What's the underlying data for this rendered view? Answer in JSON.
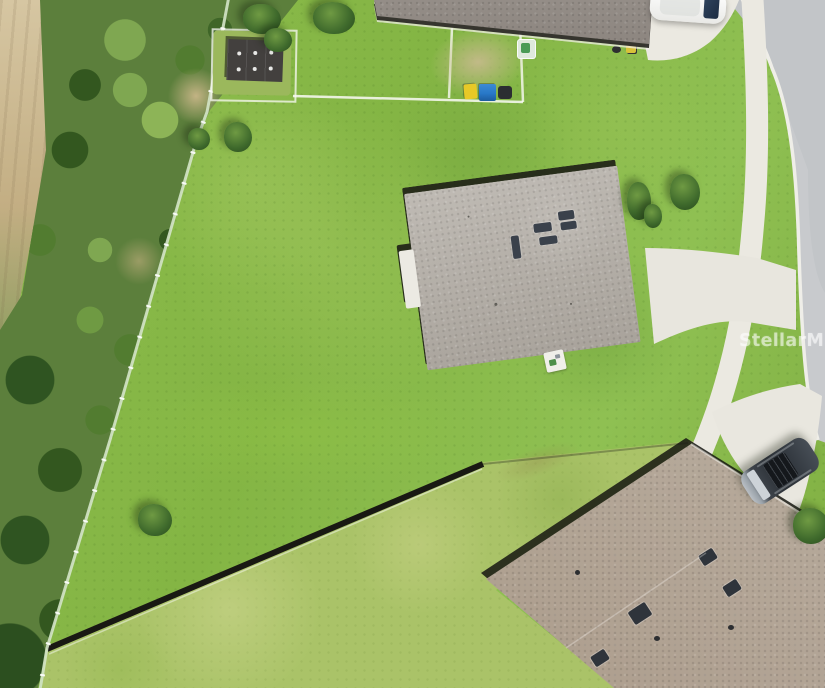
{
  "watermark": {
    "text": "StellarMLS",
    "color": "rgba(255,255,255,0.55)"
  },
  "scene": {
    "type": "aerial-drone-photograph",
    "subject": "residential corner lot with large grassy side yard",
    "objects": [
      "main-house-gray-shingle-roof",
      "neighbor-house-roof-bottom-right",
      "neighbor-house-roof-top",
      "storage-shed-roof",
      "white-car-in-top-driveway",
      "dark-gray-suv-in-neighbor-driveway",
      "curved-street-with-curb",
      "sidewalk",
      "concrete-driveways",
      "dark-rear-yard-fence",
      "light-boundary-fence",
      "wild-brush-and-palmettos",
      "sand-trail",
      "yellow-and-blue-bins",
      "roof-vents-and-skylights",
      "lawn"
    ],
    "colors": {
      "lawn": "#86b748",
      "lawn_light": "#aac368",
      "brush_green": "#3b5e2b",
      "sand": "#c9b68d",
      "road": "#c2c5c8",
      "concrete": "#eae8e0",
      "main_roof": "#b8b3ac",
      "neighbor_roof": "#b2a899",
      "top_roof": "#8e8882",
      "shed_roof": "#413e3c",
      "fence_dark": "#191913",
      "fence_light": "#d4e4c8",
      "suv_body": "#41474e",
      "car_body": "#f4f4f2",
      "bin_yellow": "#e7c927",
      "bin_blue": "#2878c8"
    }
  }
}
